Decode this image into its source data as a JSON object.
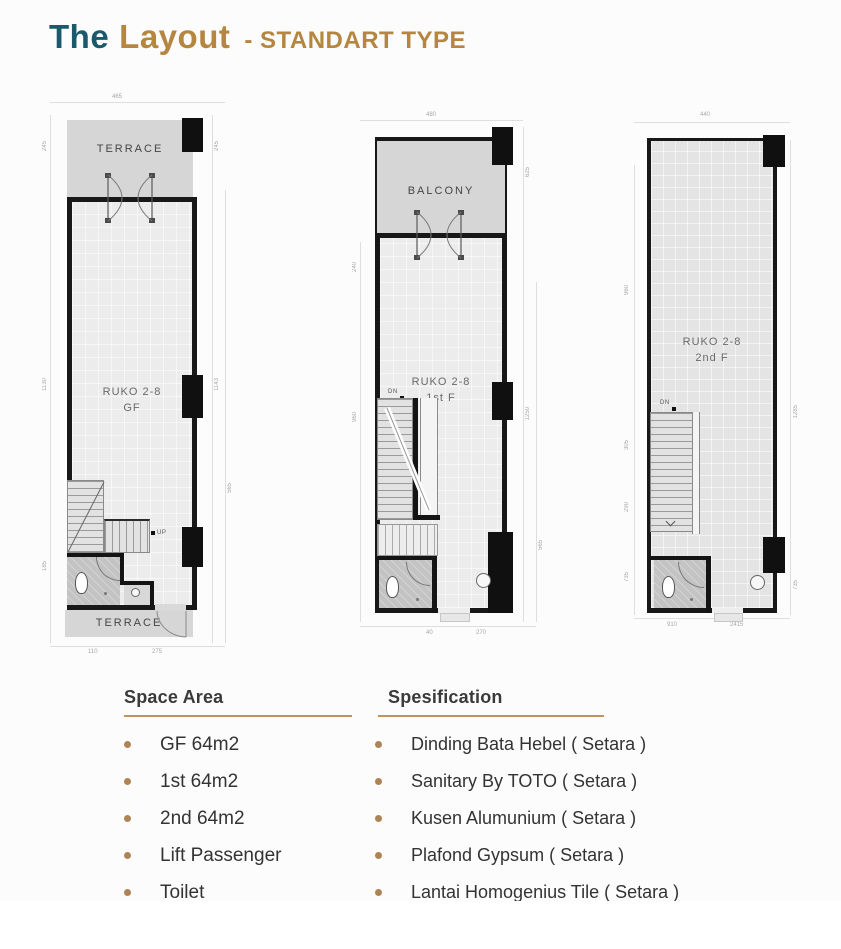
{
  "title": {
    "part1": "The",
    "part2": "Layout",
    "part3": "- STANDART TYPE"
  },
  "plans": [
    {
      "room": "RUKO 2-8",
      "floor": "GF",
      "top_label": "TERRACE",
      "bottom_label": "TERRACE",
      "stair": "UP"
    },
    {
      "room": "RUKO 2-8",
      "floor": "1st F",
      "top_label": "BALCONY",
      "stair": "DN"
    },
    {
      "room": "RUKO 2-8",
      "floor": "2nd F",
      "stair": "DN"
    }
  ],
  "space_area": {
    "heading": "Space Area",
    "items": [
      "GF 64m2",
      "1st 64m2",
      "2nd 64m2",
      "Lift Passenger",
      "Toilet",
      "Terrace"
    ]
  },
  "specification": {
    "heading": "Spesification",
    "items": [
      "Dinding Bata Hebel ( Setara )",
      "Sanitary By TOTO ( Setara )",
      "Kusen Alumunium ( Setara )",
      "Plafond Gypsum ( Setara )",
      "Lantai Homogenius Tile ( Setara )"
    ]
  },
  "dims": {
    "p1": {
      "top": "465",
      "l1": "245",
      "l2": "1130",
      "l3": "185",
      "r1": "245",
      "r2": "1143",
      "r3": "565",
      "b1": "110",
      "b2": "275"
    },
    "p2": {
      "top": "480",
      "r0": "625",
      "r1": "1250",
      "r2": "565",
      "l1": "240",
      "l2": "960",
      "b1": "40",
      "b2": "270"
    },
    "p3": {
      "top": "440",
      "l1": "960",
      "l2": "305",
      "l3": "290",
      "l4": "735",
      "r1": "1285",
      "r2": "735",
      "b1": "910",
      "b2": "2415"
    }
  },
  "colors": {
    "accent_teal": "#1b5a6d",
    "accent_gold": "#b5863f",
    "wall": "#181818",
    "area_gray": "#d6d6d6"
  }
}
